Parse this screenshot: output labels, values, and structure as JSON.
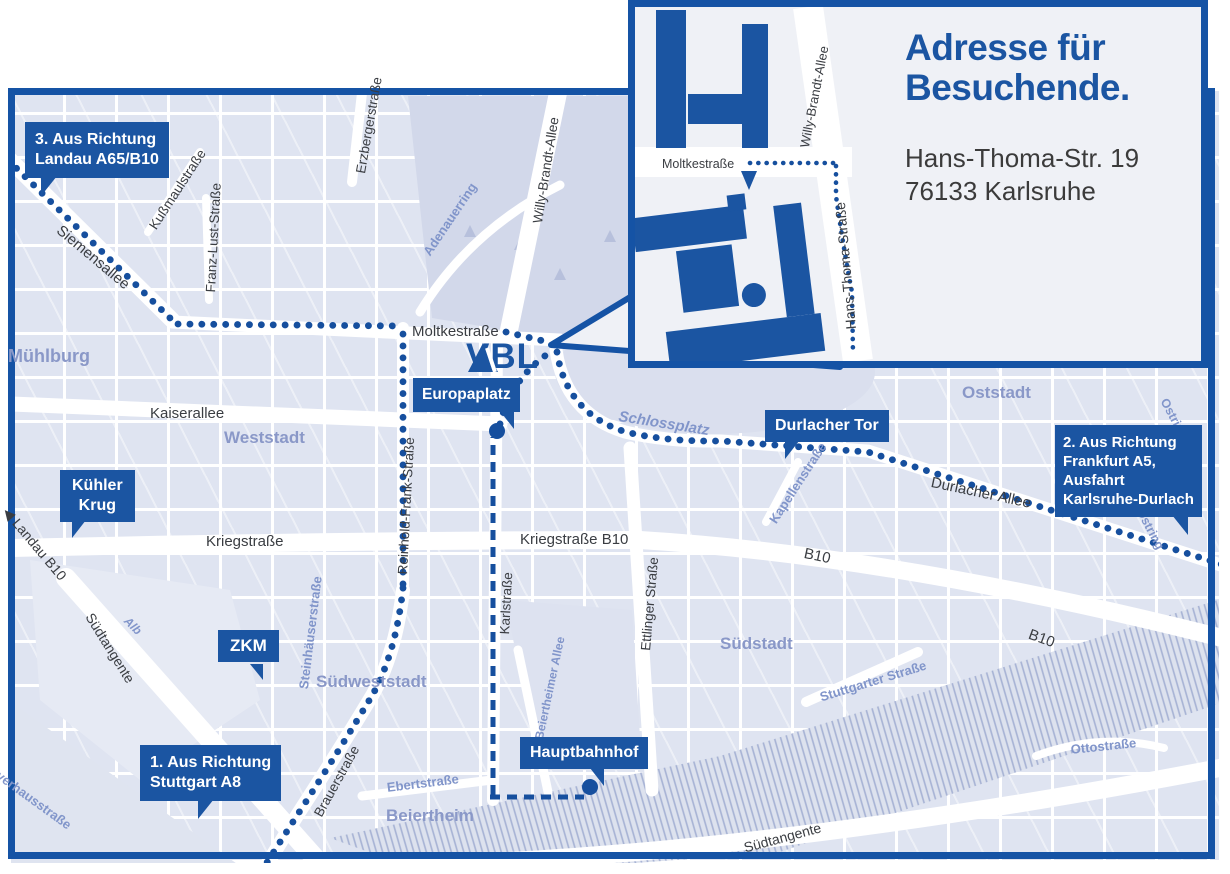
{
  "colors": {
    "brand_blue": "#1b55a2",
    "border_blue": "#1553a5",
    "route_blue": "#164f9e",
    "dark_text": "#3a3d42",
    "light_street_text": "#8195ca",
    "district_text": "#8a98c8"
  },
  "logo": {
    "vbl": "VBL"
  },
  "inset": {
    "title_line1": "Adresse für",
    "title_line2": "Besuchende.",
    "address_line1": "Hans-Thoma-Str. 19",
    "address_line2": "76133 Karlsruhe",
    "moltkestrasse": "Moltkestraße",
    "willy_brandt_allee": "Willy-Brandt-Allee",
    "hans_thoma_strasse": "Hans-Thoma-Straße"
  },
  "callouts": {
    "landau": {
      "line1": "3. Aus Richtung",
      "line2": "Landau A65/B10"
    },
    "frankfurt": {
      "line1": "2. Aus Richtung",
      "line2": "Frankfurt A5,",
      "line3": "Ausfahrt",
      "line4": "Karlsruhe-Durlach"
    },
    "stuttgart": {
      "line1": "1. Aus Richtung",
      "line2": "Stuttgart A8"
    },
    "kuehler_krug": {
      "line1": "Kühler",
      "line2": "Krug"
    },
    "zkm": "ZKM",
    "europaplatz": "Europaplatz",
    "durlacher_tor": "Durlacher Tor",
    "hauptbahnhof": "Hauptbahnhof"
  },
  "streets": {
    "siemensallee": "Siemensallee",
    "kussmaulstrasse": "Kußmaulstraße",
    "franz_lust_strasse": "Franz-Lust-Straße",
    "erzbergerstrasse": "Erzbergerstraße",
    "adenauerring": "Adenauerring",
    "willy_brandt_allee": "Willy-Brandt-Allee",
    "moltkestrasse": "Moltkestraße",
    "kaiserallee": "Kaiserallee",
    "schlossplatz": "Schlossplatz",
    "kapellenstrasse": "Kapellenstraße",
    "durlacher_allee": "Durlacher Allee",
    "kriegstrasse": "Kriegstraße",
    "kriegstrasse_b10": "Kriegstraße B10",
    "reinhold_frank_strasse": "Reinhold-Frank-Straße",
    "karlstrasse": "Karlstraße",
    "ettlinger_strasse": "Ettlinger Straße",
    "beiertheimer_allee": "Beiertheimer Allee",
    "steinhaeuserstrasse": "Steinhäuserstraße",
    "brauerstrasse": "Brauerstraße",
    "ebertstrasse": "Ebertstraße",
    "stuttgarter_strasse": "Stuttgarter Straße",
    "ottostrasse": "Ottostraße",
    "suedtangente": "Südtangente",
    "alb": "Alb",
    "landau_b10": "Landau B10",
    "pulverhausstrasse": "Pulverhausstraße",
    "ostring": "Ostring",
    "b10": "B10"
  },
  "districts": {
    "muehlburg": "Mühlburg",
    "weststadt": "Weststadt",
    "oststadt": "Oststadt",
    "suedstadt": "Südstadt",
    "suedweststadt": "Südweststadt",
    "beiertheim": "Beiertheim"
  },
  "icons": {
    "landau_arrow": "◀"
  }
}
